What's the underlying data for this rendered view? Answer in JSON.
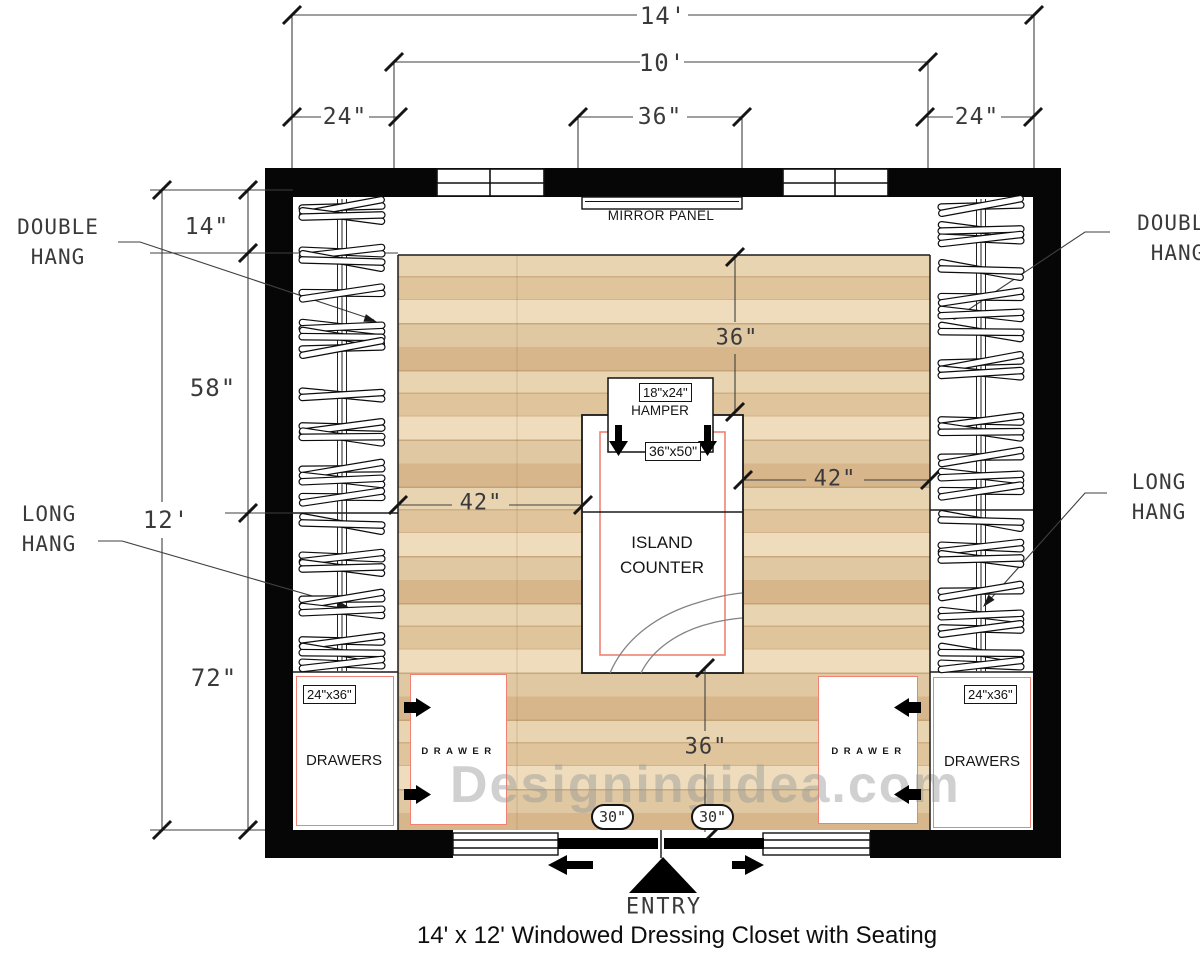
{
  "page": {
    "title": "14' x 12' Windowed Dressing Closet with Seating",
    "watermark": "Designingidea.com"
  },
  "colors": {
    "wall": "#060606",
    "furniture_outline": "#f08275",
    "dimension_line": "#3f3f3f",
    "floor_base": "#e2c9a2",
    "watermark": "#b9b9b9"
  },
  "dimensions": {
    "overall_width": "14'",
    "open_floor_width": "10'",
    "left_closet_depth": "24\"",
    "mirror_width": "36\"",
    "right_closet_depth": "24\"",
    "top_return_depth": "14\"",
    "double_hang_length": "58\"",
    "overall_depth": "12'",
    "long_hang_length": "72\"",
    "mirror_clearance": "36\"",
    "island_clearance_left": "42\"",
    "island_clearance_right": "42\"",
    "entry_clearance": "36\"",
    "door_panel_left": "30\"",
    "door_panel_right": "30\""
  },
  "labels": {
    "mirror_panel": "MIRROR PANEL",
    "double_hang_left": [
      "DOUBLE",
      "HANG"
    ],
    "double_hang_right": [
      "DOUBLE",
      "HANG"
    ],
    "long_hang_left": [
      "LONG",
      "HANG"
    ],
    "long_hang_right": [
      "LONG",
      "HANG"
    ],
    "island": [
      "ISLAND",
      "COUNTER"
    ],
    "entry": "ENTRY"
  },
  "furniture": {
    "hamper_size": "18\"x24\"",
    "hamper": "HAMPER",
    "island_size": "36\"x50\"",
    "drawers_left": "DRAWERS",
    "drawers_left_size": "24\"x36\"",
    "drawers_right": "DRAWERS",
    "drawers_right_size": "24\"x36\"",
    "drawer_tower_left": "DRAWER",
    "drawer_tower_right": "DRAWER"
  }
}
